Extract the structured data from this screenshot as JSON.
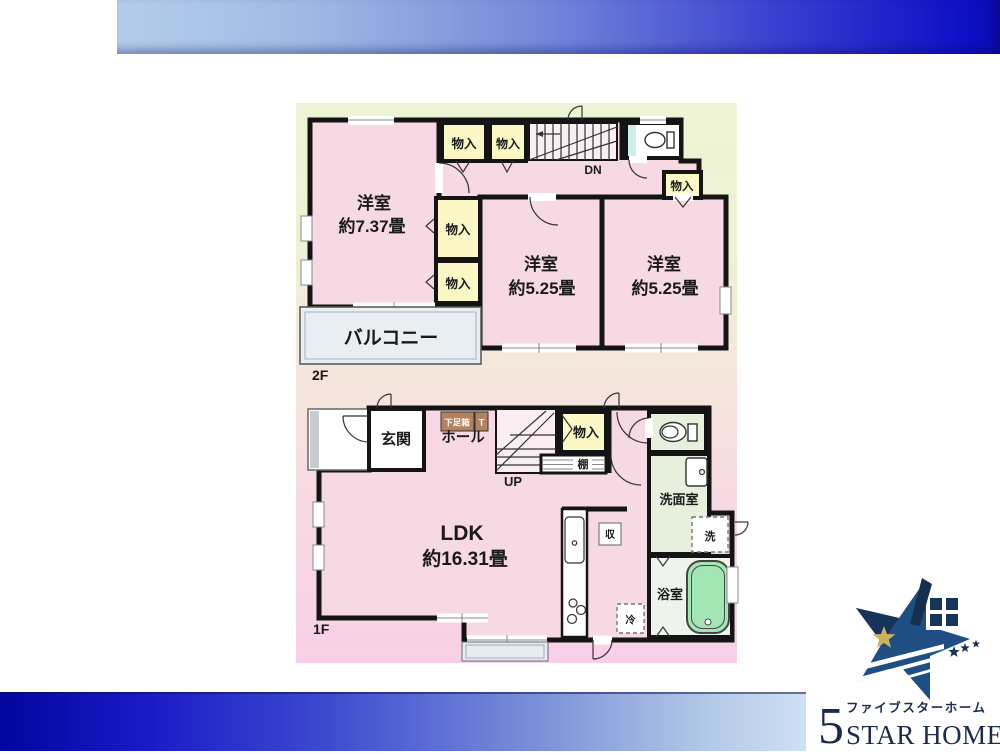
{
  "colors": {
    "room_pink": "#f7d9e3",
    "closet_yellow": "#fbf8c6",
    "washroom_green": "#e6f0dc",
    "tub_green": "#a3e6b3",
    "balcony_gray": "#e9eef3",
    "shoebox_brown": "#b5825f",
    "header_blue_dark": "#0f0fc6",
    "header_blue_light": "#b5cde9",
    "logo_navy": "#1b2b4a"
  },
  "floor2": {
    "floor_label": "2F",
    "room_737": {
      "name": "洋室",
      "size": "約7.37畳"
    },
    "room_525a": {
      "name": "洋室",
      "size": "約5.25畳"
    },
    "room_525b": {
      "name": "洋室",
      "size": "約5.25畳"
    },
    "closet_top1": "物入",
    "closet_top2": "物入",
    "closet_mid1": "物入",
    "closet_mid2": "物入",
    "closet_right": "物入",
    "stairs_label": "DN",
    "balcony": "バルコニー"
  },
  "floor1": {
    "floor_label": "1F",
    "entrance": "玄関",
    "shoe_box": "下足箱",
    "shoe_box_t": "T",
    "hall": "ホール",
    "stairs_label": "UP",
    "closet": "物入",
    "shelf": "棚",
    "ldk": {
      "name": "LDK",
      "size": "約16.31畳"
    },
    "storage": "収",
    "fridge": "冷",
    "washroom": "洗面室",
    "washer": "洗",
    "bathroom": "浴室"
  },
  "logo": {
    "five": "5",
    "kana": "ファイブスターホーム",
    "latin": "STAR HOME",
    "suffix_top": "株式",
    "suffix_bottom": "会社"
  }
}
